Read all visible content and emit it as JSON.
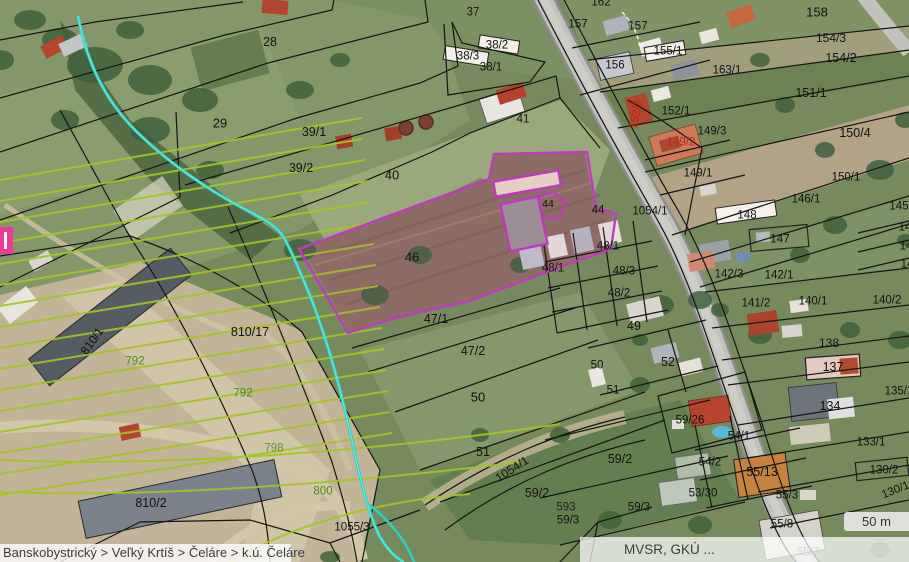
{
  "map": {
    "selected_parcel": "46",
    "breadcrumb": {
      "items": [
        "Banskobystrický",
        "Veľký Krtíš",
        "Čeláre",
        "k.ú. Čeláre"
      ],
      "text": "Banskobystrický > Veľký Krtíš > Čeláre > k.ú. Čeláre"
    },
    "attribution": {
      "text": "MVSR, GKÚ ..."
    },
    "scale_bar": {
      "label": "50 m"
    },
    "colors": {
      "selection_outline": "#c03ac0",
      "stream_line": "#2fd0c4",
      "utility_hatch_line": "#a4c524",
      "parcel_boundary": "#151515",
      "red_label": "#cc2211",
      "green_label": "#4a8a1a",
      "marker_pink": "#ee3a96"
    },
    "parcel_labels": [
      {
        "t": "37",
        "x": 473,
        "y": 13
      },
      {
        "t": "28",
        "x": 270,
        "y": 42,
        "s": 12.5
      },
      {
        "t": "162",
        "x": 601,
        "y": 3
      },
      {
        "t": "157",
        "x": 578,
        "y": 25
      },
      {
        "t": "157",
        "x": 638,
        "y": 27
      },
      {
        "t": "158",
        "x": 817,
        "y": 12,
        "s": 13
      },
      {
        "t": "38/2",
        "x": 497,
        "y": 46
      },
      {
        "t": "38/3",
        "x": 468,
        "y": 57
      },
      {
        "t": "38/1",
        "x": 491,
        "y": 68
      },
      {
        "t": "156",
        "x": 615,
        "y": 66
      },
      {
        "t": "155/1",
        "x": 668,
        "y": 52
      },
      {
        "t": "163/1",
        "x": 727,
        "y": 71
      },
      {
        "t": "154/3",
        "x": 831,
        "y": 38,
        "s": 12
      },
      {
        "t": "154/2",
        "x": 841,
        "y": 58,
        "s": 12.5
      },
      {
        "t": "151/1",
        "x": 811,
        "y": 93,
        "s": 12.5
      },
      {
        "t": "29",
        "x": 220,
        "y": 123,
        "s": 13
      },
      {
        "t": "39/1",
        "x": 314,
        "y": 132,
        "s": 12.5
      },
      {
        "t": "39/2",
        "x": 301,
        "y": 168,
        "s": 12.5
      },
      {
        "t": "40",
        "x": 392,
        "y": 175,
        "s": 13
      },
      {
        "t": "41",
        "x": 523,
        "y": 120
      },
      {
        "t": "152/1",
        "x": 676,
        "y": 112
      },
      {
        "t": "152/2",
        "x": 637,
        "y": 115,
        "c": "red",
        "r": -78
      },
      {
        "t": "149/2",
        "x": 681,
        "y": 143,
        "c": "red"
      },
      {
        "t": "149/3",
        "x": 712,
        "y": 132
      },
      {
        "t": "149/1",
        "x": 698,
        "y": 174
      },
      {
        "t": "150/4",
        "x": 855,
        "y": 133,
        "s": 12.5
      },
      {
        "t": "150/1",
        "x": 846,
        "y": 178
      },
      {
        "t": "1054/1",
        "x": 650,
        "y": 212
      },
      {
        "t": "148",
        "x": 747,
        "y": 216
      },
      {
        "t": "147",
        "x": 780,
        "y": 240
      },
      {
        "t": "146/1",
        "x": 806,
        "y": 200
      },
      {
        "t": "145",
        "x": 899,
        "y": 207
      },
      {
        "t": "14",
        "x": 905,
        "y": 228
      },
      {
        "t": "14",
        "x": 906,
        "y": 247
      },
      {
        "t": "14",
        "x": 907,
        "y": 265
      },
      {
        "t": "142/3",
        "x": 729,
        "y": 275
      },
      {
        "t": "142/1",
        "x": 779,
        "y": 276
      },
      {
        "t": "141/2",
        "x": 756,
        "y": 304
      },
      {
        "t": "140/1",
        "x": 813,
        "y": 302
      },
      {
        "t": "140/2",
        "x": 887,
        "y": 301
      },
      {
        "t": "46",
        "x": 412,
        "y": 257,
        "s": 13
      },
      {
        "t": "44",
        "x": 548,
        "y": 204,
        "s": 10.5
      },
      {
        "t": "44",
        "x": 598,
        "y": 211
      },
      {
        "t": "48/1",
        "x": 608,
        "y": 247
      },
      {
        "t": "48/1",
        "x": 553,
        "y": 269
      },
      {
        "t": "48/3",
        "x": 624,
        "y": 272
      },
      {
        "t": "48/2",
        "x": 619,
        "y": 294
      },
      {
        "t": "47/1",
        "x": 436,
        "y": 319,
        "s": 12.5
      },
      {
        "t": "47/2",
        "x": 473,
        "y": 351,
        "s": 12.5
      },
      {
        "t": "49",
        "x": 634,
        "y": 326,
        "s": 12.5
      },
      {
        "t": "50",
        "x": 597,
        "y": 366
      },
      {
        "t": "52",
        "x": 668,
        "y": 362,
        "s": 12.5
      },
      {
        "t": "51",
        "x": 613,
        "y": 391
      },
      {
        "t": "50",
        "x": 478,
        "y": 397,
        "s": 13
      },
      {
        "t": "51",
        "x": 483,
        "y": 452,
        "s": 12.5
      },
      {
        "t": "138",
        "x": 829,
        "y": 343,
        "s": 12
      },
      {
        "t": "137",
        "x": 833,
        "y": 367,
        "s": 12.5
      },
      {
        "t": "135/1",
        "x": 899,
        "y": 392
      },
      {
        "t": "134",
        "x": 830,
        "y": 406,
        "s": 12.5
      },
      {
        "t": "133/1",
        "x": 871,
        "y": 443
      },
      {
        "t": "130/2",
        "x": 884,
        "y": 471
      },
      {
        "t": "130/1",
        "x": 896,
        "y": 491,
        "r": -22
      },
      {
        "t": "59/26",
        "x": 690,
        "y": 421
      },
      {
        "t": "59/2",
        "x": 620,
        "y": 459,
        "s": 12.5
      },
      {
        "t": "59/2",
        "x": 537,
        "y": 493,
        "s": 12.5
      },
      {
        "t": "59/3",
        "x": 639,
        "y": 508
      },
      {
        "t": "59/3",
        "x": 568,
        "y": 521
      },
      {
        "t": "1054/1",
        "x": 512,
        "y": 469,
        "r": -33,
        "s": 12
      },
      {
        "t": "54/1",
        "x": 739,
        "y": 437
      },
      {
        "t": "54/2",
        "x": 710,
        "y": 463
      },
      {
        "t": "55/13",
        "x": 762,
        "y": 472,
        "s": 12.5
      },
      {
        "t": "53/30",
        "x": 703,
        "y": 494
      },
      {
        "t": "55/3",
        "x": 787,
        "y": 496
      },
      {
        "t": "55/8",
        "x": 782,
        "y": 525
      },
      {
        "t": "593",
        "x": 566,
        "y": 508,
        "o": 0.85
      },
      {
        "t": "810/17",
        "x": 250,
        "y": 332,
        "s": 12.5
      },
      {
        "t": "810/1",
        "x": 92,
        "y": 341,
        "r": -55,
        "s": 12
      },
      {
        "t": "810/2",
        "x": 151,
        "y": 503,
        "s": 12.5
      },
      {
        "t": "1055/3",
        "x": 352,
        "y": 528
      },
      {
        "t": "792",
        "x": 135,
        "y": 362,
        "c": "green"
      },
      {
        "t": "792",
        "x": 243,
        "y": 394,
        "c": "green"
      },
      {
        "t": "800",
        "x": 323,
        "y": 492,
        "c": "green"
      },
      {
        "t": "798",
        "x": 274,
        "y": 449,
        "c": "green",
        "o": 0.8
      },
      {
        "t": "57",
        "x": 693,
        "y": 553,
        "o": 0.45
      },
      {
        "t": "55/7",
        "x": 808,
        "y": 553,
        "o": 0.45
      }
    ]
  }
}
